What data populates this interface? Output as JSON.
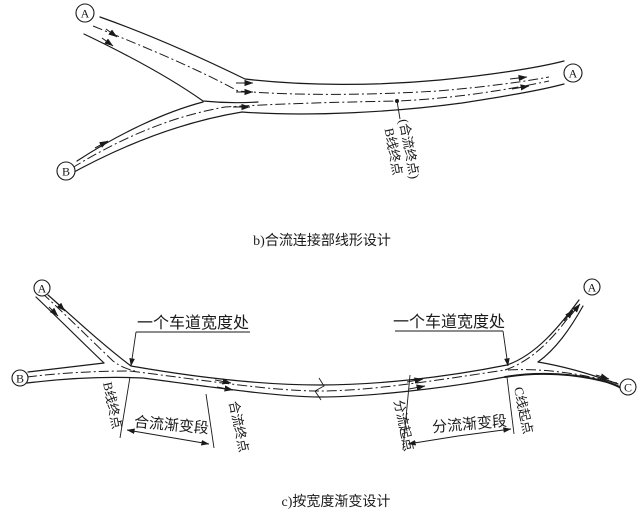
{
  "colors": {
    "ink": "#1a1a1a",
    "background": "#ffffff"
  },
  "diagram_b": {
    "caption": "b)合流连接部线形设计",
    "nodes": {
      "a_left": "A",
      "b_left": "B",
      "a_right": "A"
    },
    "annotation": {
      "line1": "(合流终点)",
      "line2": "B线终点"
    }
  },
  "diagram_c": {
    "caption": "c)按宽度渐变设计",
    "nodes": {
      "a_left": "A",
      "b_left": "B",
      "a_right": "A",
      "c_right": "C"
    },
    "labels": {
      "lane_width_left": "一个车道宽度处",
      "lane_width_right": "一个车道宽度处",
      "b_line_end": "B线终点",
      "merge_taper": "合流渐变段",
      "merge_end": "合流终点",
      "diverge_start": "分流起点",
      "diverge_taper": "分流渐变段",
      "c_line_start": "C线起点"
    }
  }
}
